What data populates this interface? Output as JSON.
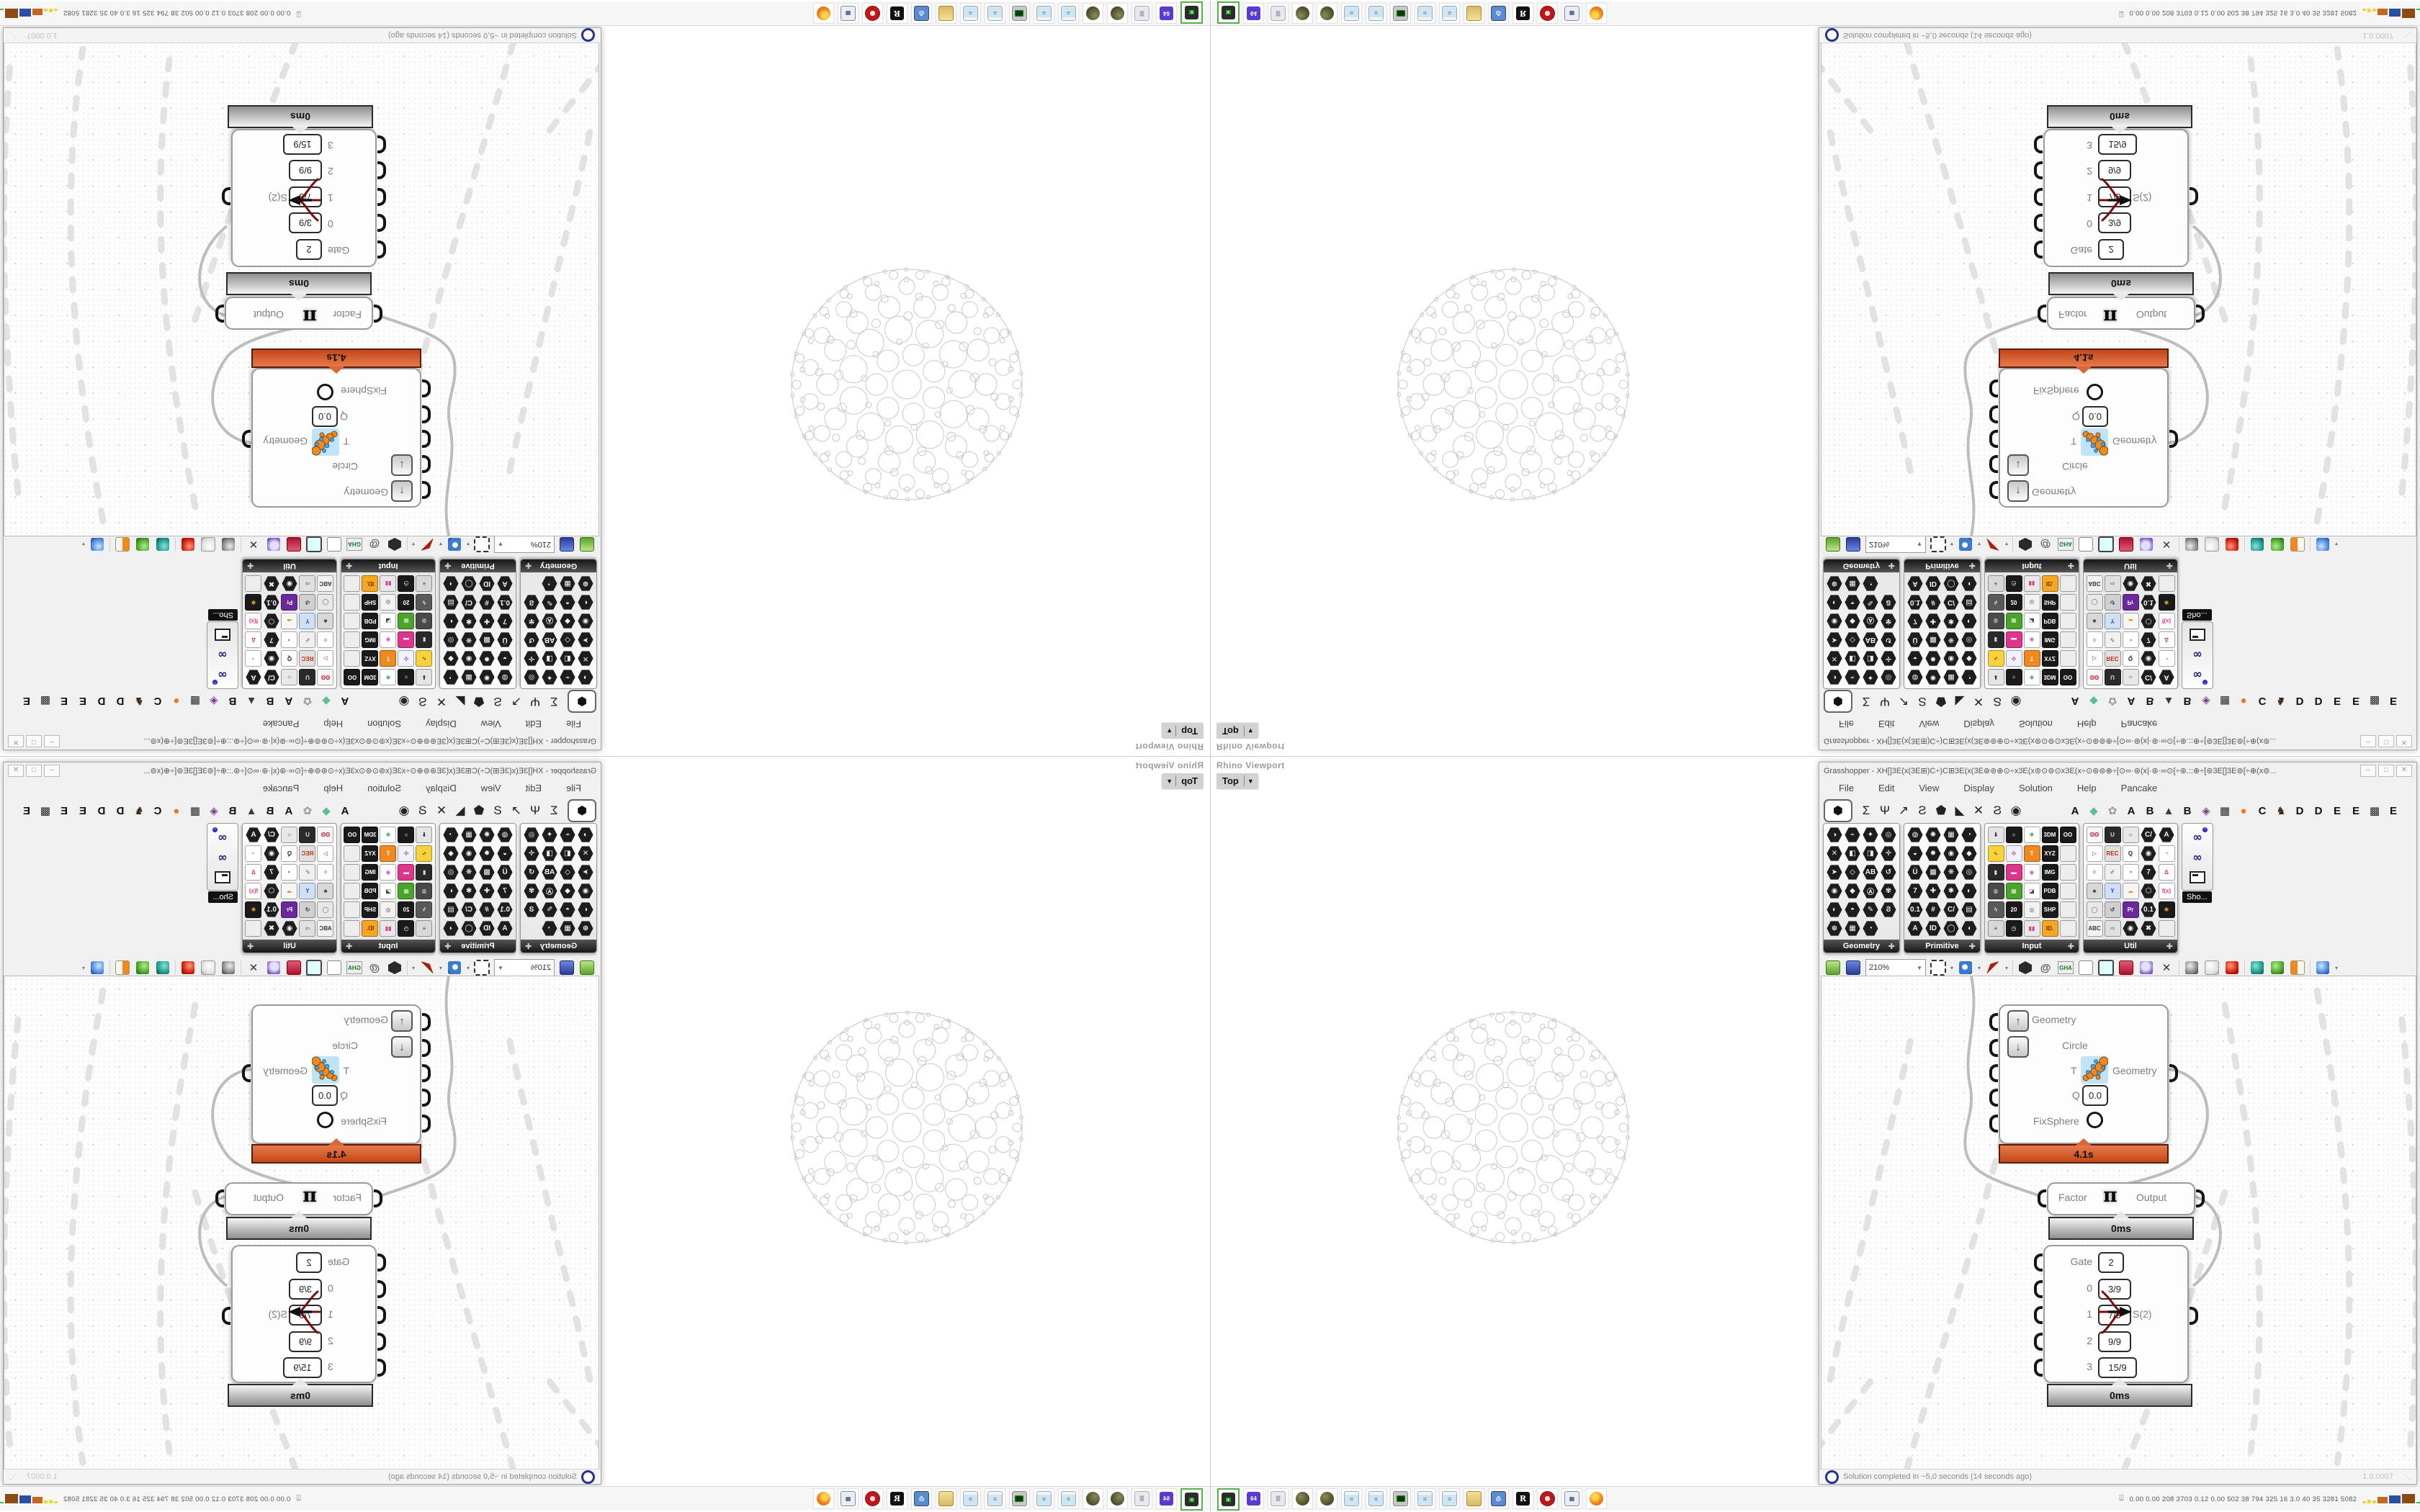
{
  "viewport": {
    "panel_label": "Rhino Viewport",
    "view_button": "Top",
    "caret": "▼"
  },
  "grasshopper": {
    "title": "Grasshopper - XH[]3E(x(3E⊞)C÷)C⊞3E(x(3E⊛⊚⊕⊙÷x3E(x⊚⊙⊚⊙x3E(x÷⊙⊛⊚⊕÷[⊙∞·⊛(x|·⊛·∞⊙[÷⊛.::⊕÷[⊚3E[]3E⊚[÷⊕(x⊚...",
    "window_buttons": [
      "–",
      "□",
      "✕"
    ],
    "menus": [
      "File",
      "Edit",
      "View",
      "Display",
      "Solution",
      "Help",
      "Pancake"
    ],
    "tabs": {
      "active_glyph": "⬢",
      "icon_tabs": [
        "Σ",
        "Ψ",
        "↗",
        "Ƨ",
        "⬟",
        "◣",
        "✕",
        "Ϩ",
        "◉"
      ],
      "letter_tabs": [
        {
          "t": "A",
          "c": "#111"
        },
        {
          "t": "◆",
          "c": "#5bbf8e"
        },
        {
          "t": "✿",
          "c": "#9a9a9a"
        },
        {
          "t": "A",
          "c": "#111"
        },
        {
          "t": "B",
          "c": "#111"
        },
        {
          "t": "▲",
          "c": "#3a3a3a"
        },
        {
          "t": "B",
          "c": "#111"
        },
        {
          "t": "◈",
          "c": "#7a3a8a"
        },
        {
          "t": "▦",
          "c": "#222"
        },
        {
          "t": "●",
          "c": "#f07818"
        },
        {
          "t": "C",
          "c": "#111"
        },
        {
          "t": "♞",
          "c": "#3a2a1a"
        },
        {
          "t": "D",
          "c": "#111"
        },
        {
          "t": "D",
          "c": "#111"
        },
        {
          "t": "E",
          "c": "#111"
        },
        {
          "t": "E",
          "c": "#111"
        },
        {
          "t": "▩",
          "c": "#222"
        },
        {
          "t": "E",
          "c": "#111"
        }
      ]
    },
    "palettes": [
      {
        "name": "Geometry",
        "cols": 4,
        "cells": [
          {
            "t": "◑"
          },
          {
            "t": "⌁"
          },
          {
            "t": "✦"
          },
          {
            "t": "◎"
          },
          {
            "t": "✕"
          },
          {
            "t": "◧"
          },
          {
            "t": "◨"
          },
          {
            "t": "✛"
          },
          {
            "t": "➤"
          },
          {
            "t": "◇"
          },
          {
            "t": "AB"
          },
          {
            "t": "↺"
          },
          {
            "t": "◉"
          },
          {
            "t": "◆"
          },
          {
            "t": "Ⓐ"
          },
          {
            "t": "✾"
          },
          {
            "t": "◐"
          },
          {
            "t": "◓"
          },
          {
            "t": "✎"
          },
          {
            "t": "Ϩ"
          },
          {
            "t": "⊕"
          },
          {
            "t": "▦"
          },
          {
            "t": "◔"
          },
          {
            "t": ""
          }
        ]
      },
      {
        "name": "Primitive",
        "cols": 4,
        "cells": [
          {
            "t": "◍"
          },
          {
            "t": "✺"
          },
          {
            "t": "▦"
          },
          {
            "t": "◔"
          },
          {
            "t": "◒"
          },
          {
            "t": "✹"
          },
          {
            "t": "◉"
          },
          {
            "t": "◆"
          },
          {
            "t": "Ü"
          },
          {
            "t": "▩"
          },
          {
            "t": "❋"
          },
          {
            "t": "◎"
          },
          {
            "t": "7"
          },
          {
            "t": "✚"
          },
          {
            "t": "✱"
          },
          {
            "t": "◐"
          },
          {
            "t": "0.1"
          },
          {
            "t": "#"
          },
          {
            "t": "C/"
          },
          {
            "t": "▤"
          },
          {
            "t": "A"
          },
          {
            "t": "ID"
          },
          {
            "t": "◯"
          },
          {
            "t": "◖"
          }
        ]
      },
      {
        "name": "Input",
        "cols": 5,
        "cells": [
          {
            "t": "⬇",
            "sq": "#e4e4e4",
            "fg": "#333"
          },
          {
            "t": "■",
            "sq": "#1a1a1a",
            "fg": "#555"
          },
          {
            "t": "❖",
            "sq": "#fff",
            "fg": "#2aa05a"
          },
          {
            "t": "3DM",
            "sq": "#1a1a1a",
            "fg": "#fff"
          },
          {
            "t": "OO",
            "sq": "#1a1a1a",
            "fg": "#fff"
          },
          {
            "t": "∿",
            "sq": "#f6d33c",
            "fg": "#7a5a00"
          },
          {
            "t": "✣",
            "sq": "#eef2ff",
            "fg": "#c03060"
          },
          {
            "t": "T",
            "sq": "#f08a1e",
            "fg": "#fff"
          },
          {
            "t": "XYZ",
            "sq": "#1a1a1a",
            "fg": "#fff"
          },
          {
            "t": "",
            "sq": "#ededed",
            "fg": "#999"
          },
          {
            "t": "▮",
            "sq": "#2a2a2a",
            "fg": "#ddd"
          },
          {
            "t": "▬",
            "sq": "#e0358c",
            "fg": "#fff"
          },
          {
            "t": "◉",
            "sq": "#fff",
            "fg": "#d060d0"
          },
          {
            "t": "IMG",
            "sq": "#1a1a1a",
            "fg": "#fff"
          },
          {
            "t": "",
            "sq": "#ededed",
            "fg": "#999"
          },
          {
            "t": "◍",
            "sq": "#4a4a4a",
            "fg": "#ddd"
          },
          {
            "t": "▦",
            "sq": "#4aa32a",
            "fg": "#d6f6c6"
          },
          {
            "t": "◪",
            "sq": "#fff",
            "fg": "#444"
          },
          {
            "t": "PDB",
            "sq": "#1a1a1a",
            "fg": "#fff"
          },
          {
            "t": "",
            "sq": "#ededed",
            "fg": "#999"
          },
          {
            "t": "ϟ",
            "sq": "#5a5a5a",
            "fg": "#eee"
          },
          {
            "t": "20",
            "sq": "#1a1a1a",
            "fg": "#fff"
          },
          {
            "t": "◎",
            "sq": "#f2f2f2",
            "fg": "#555"
          },
          {
            "t": "SHP",
            "sq": "#1a1a1a",
            "fg": "#fff"
          },
          {
            "t": "",
            "sq": "#ededed",
            "fg": "#999"
          },
          {
            "t": "≡",
            "sq": "#d8d8d8",
            "fg": "#444"
          },
          {
            "t": "◷",
            "sq": "#1a1a1a",
            "fg": "#fff"
          },
          {
            "t": "▮▮",
            "sq": "#e8e8e8",
            "fg": "#e0358c"
          },
          {
            "t": "ID.",
            "sq": "#f5a623",
            "fg": "#7a2a00"
          },
          {
            "t": "",
            "sq": "#ededed",
            "fg": "#999"
          }
        ]
      },
      {
        "name": "Util",
        "cols": 5,
        "cells": [
          {
            "t": "ʘʘ",
            "sq": "#f6f6f6",
            "fg": "#c01828"
          },
          {
            "t": "U",
            "sq": "#2a2a2a",
            "fg": "#ddd"
          },
          {
            "t": "➩",
            "sq": "#e8e8e8",
            "fg": "#888"
          },
          {
            "t": "C/"
          },
          {
            "t": "A"
          },
          {
            "t": "▷",
            "sq": "#fff",
            "fg": "#c02020"
          },
          {
            "t": "REC",
            "sq": "#e0e0e0",
            "fg": "#c03010"
          },
          {
            "t": "Q",
            "sq": "#fff",
            "fg": "#222"
          },
          {
            "t": "◉"
          },
          {
            "t": "◔",
            "sq": "#fff",
            "fg": "#e0358c"
          },
          {
            "t": "⚛",
            "sq": "#fff",
            "fg": "#3a8a3a"
          },
          {
            "t": "✐",
            "sq": "#f0f0f0",
            "fg": "#7a5a2a"
          },
          {
            "t": "◔",
            "sq": "#fff",
            "fg": "#222"
          },
          {
            "t": "7"
          },
          {
            "t": "Δ",
            "sq": "#fff",
            "fg": "#e0358c"
          },
          {
            "t": "♣",
            "sq": "#d8d8d8",
            "fg": "#3a3a3a"
          },
          {
            "t": "Y",
            "sq": "#cfe0f6",
            "fg": "#2a4a8a"
          },
          {
            "t": "☁",
            "sq": "#f6f6f6",
            "fg": "#d0a020"
          },
          {
            "t": "⬡"
          },
          {
            "t": "f(x)",
            "sq": "#fff",
            "fg": "#e0358c"
          },
          {
            "t": "◯",
            "sq": "#e8e8e8",
            "fg": "#555"
          },
          {
            "t": "↺",
            "sq": "#d0d0d0",
            "fg": "#333"
          },
          {
            "t": "Pr",
            "sq": "#6a2a9a",
            "fg": "#fff"
          },
          {
            "t": "0.1"
          },
          {
            "t": "✱",
            "sq": "#1a1a1a",
            "fg": "#e0a030"
          },
          {
            "t": "ABC",
            "sq": "#f2f2f2",
            "fg": "#333"
          },
          {
            "t": "⇨",
            "sq": "#e0e0e0",
            "fg": "#666"
          },
          {
            "t": "◉"
          },
          {
            "t": "✖"
          },
          {
            "t": "",
            "sq": "#ededed",
            "fg": "#999"
          }
        ]
      }
    ],
    "float_tools": {
      "tooltip": "Sho...",
      "items": [
        "goggles-info",
        "goggles-curve",
        "projector-screen"
      ]
    },
    "toolbar": {
      "zoom_value": "210%",
      "icons": [
        "open-file",
        "save-file",
        "zoom-fit",
        "preview-eye",
        "sketch-quill",
        "pivot-box",
        "at-link",
        "gha-assembly",
        "doc-search",
        "find-component",
        "gift-box",
        "idea-bulb",
        "ribbon-cross",
        "preview-off",
        "preview-wire",
        "preview-shaded",
        "pin-teal",
        "pin-green",
        "ball-orange",
        "ball-blue"
      ]
    },
    "statusbar": {
      "text": "Solution completed in ~5,0 seconds (14 seconds ago)",
      "version": "1.0.0007"
    }
  },
  "nodes": {
    "main": {
      "row_geometry": "Geometry",
      "row_circle": "Circle",
      "row_t": "T",
      "output_label": "Geometry",
      "row_q": "Q",
      "q_value": "0.0",
      "row_fixsphere": "FixSphere",
      "runtime": "4.1s",
      "icon": "caterpillar-circles"
    },
    "factor": {
      "left": "Factor",
      "symbol": "π",
      "right": "Output",
      "runtime": "0ms"
    },
    "gate": {
      "rows": [
        {
          "label": "Gate",
          "value": "2"
        },
        {
          "label": "0",
          "value": "3/9"
        },
        {
          "label": "1",
          "value": "7/9"
        },
        {
          "label": "2",
          "value": "9/9"
        },
        {
          "label": "3",
          "value": "15/9"
        }
      ],
      "output": "S(2)",
      "runtime": "0ms"
    }
  },
  "taskbar": {
    "icons": [
      {
        "name": "green-device",
        "kind": "device",
        "label": "▣",
        "selected": true
      },
      {
        "name": "floppy-64",
        "kind": "floppy",
        "label": "64"
      },
      {
        "name": "scroll-doc",
        "kind": "scroll",
        "label": "≣"
      },
      {
        "name": "camo-ball-1",
        "kind": "camo",
        "label": ""
      },
      {
        "name": "camo-ball-2",
        "kind": "camo",
        "label": ""
      },
      {
        "name": "notepad-1",
        "kind": "note",
        "label": "≡"
      },
      {
        "name": "notepad-2",
        "kind": "note",
        "label": "≡"
      },
      {
        "name": "terminal-monitor",
        "kind": "term",
        "label": ""
      },
      {
        "name": "notepad-3",
        "kind": "note",
        "label": "≡"
      },
      {
        "name": "notepad-4",
        "kind": "note",
        "label": "≡"
      },
      {
        "name": "folder",
        "kind": "folder",
        "label": ""
      },
      {
        "name": "login-monitor",
        "kind": "login",
        "label": "⎙"
      },
      {
        "name": "rhino",
        "kind": "rhino",
        "label": "R"
      },
      {
        "name": "red-gear",
        "kind": "redgear",
        "label": ""
      },
      {
        "name": "calculator",
        "kind": "calc",
        "label": "▦"
      },
      {
        "name": "firefox",
        "kind": "firefox",
        "label": ""
      }
    ],
    "monitor": {
      "person_glyph": "⍍",
      "values": "0.00 0.00  208  3703 0.12 0.00  502   38   794  325   16   3.0   40   35  3281 5082",
      "bars": [
        {
          "c": "#e8d83a",
          "h": 3,
          "w": 5
        },
        {
          "c": "#e8d83a",
          "h": 5,
          "w": 5
        },
        {
          "c": "#e8d83a",
          "h": 4,
          "w": 5
        },
        {
          "c": "#c9641e",
          "h": 9,
          "w": 14
        },
        {
          "c": "#2a4fa0",
          "h": 11,
          "w": 16
        },
        {
          "c": "#8a4a12",
          "h": 13,
          "w": 18
        },
        {
          "c": "#3ac04a",
          "h": 2,
          "w": 16
        },
        {
          "c": "#c03030",
          "h": 3,
          "w": 16
        }
      ]
    }
  },
  "sphere_pattern": {
    "outer_r": 160,
    "rings": [
      {
        "count": 1,
        "dist": 0,
        "r": 20,
        "phase": 0
      },
      {
        "count": 7,
        "dist": 42,
        "r": 15,
        "phase": 0
      },
      {
        "count": 11,
        "dist": 77,
        "r": 19,
        "phase": 16
      },
      {
        "count": 14,
        "dist": 110,
        "r": 15,
        "phase": 0
      },
      {
        "count": 18,
        "dist": 136,
        "r": 11,
        "phase": 10
      },
      {
        "count": 26,
        "dist": 153,
        "r": 6,
        "phase": 0
      },
      {
        "count": 34,
        "dist": 159.5,
        "r": 2.5,
        "phase": 5
      }
    ]
  }
}
